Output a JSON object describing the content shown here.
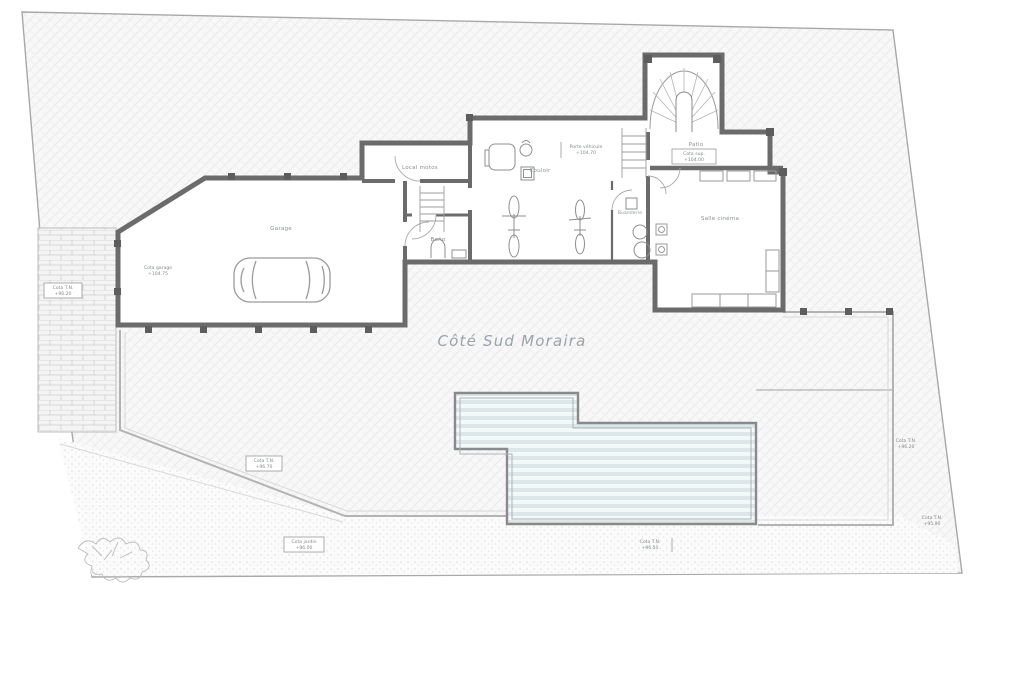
{
  "title": "Côté Sud Moraira",
  "plan": {
    "rooms": {
      "garage": "Garage",
      "local_motos": "Local motos",
      "couloir": "Couloir",
      "bano": "Baño",
      "buanderie": "Buanderie",
      "patio": "Patio",
      "cinema": "Salle cinéma"
    },
    "cotes": {
      "garage": {
        "label": "Cota garage",
        "value": "+104.75"
      },
      "tn_left": {
        "label": "Cota T.N.",
        "value": "+96.20"
      },
      "vehicule": {
        "label": "Porte véhicule",
        "value": "+104.70"
      },
      "patio": {
        "label": "Cota sup.",
        "value": "+104.00"
      },
      "tn_mid": {
        "label": "Cota T.N.",
        "value": "+96.70"
      },
      "jardin": {
        "label": "Cota jardin",
        "value": "+96.00"
      },
      "piscine": {
        "label": "Cota T.N.",
        "value": "+96.50"
      },
      "tn_right": {
        "label": "Cota T.N.",
        "value": "+96.20"
      },
      "tn_br": {
        "label": "Cota T.N.",
        "value": "+95.90"
      }
    },
    "colors": {
      "water_stripe": "#dce7eb",
      "wall": "#6b6b6b",
      "terrain_hatch": "#ededed",
      "title_text": "#9aa4ab"
    }
  }
}
